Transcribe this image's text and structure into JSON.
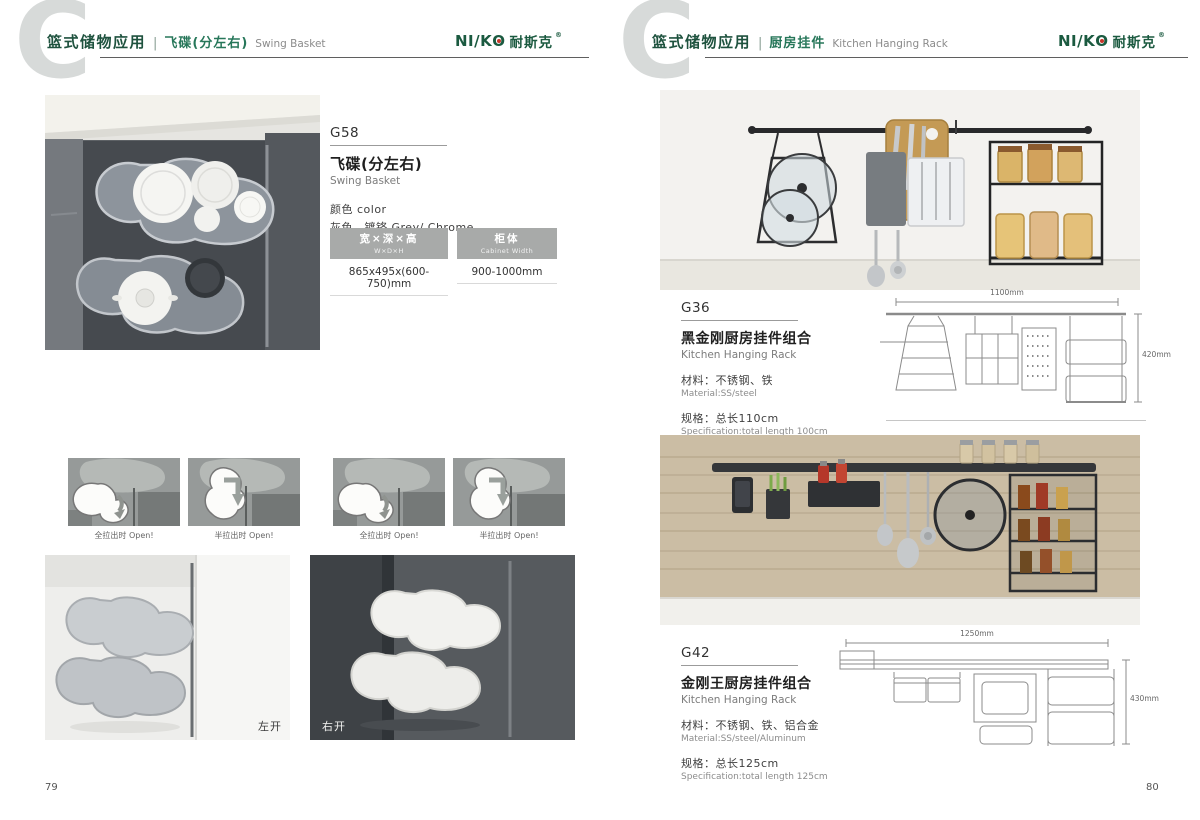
{
  "shared": {
    "watermark": "C",
    "header_sep": "|",
    "logo": {
      "latin": "NI/K",
      "o": "O",
      "cn": "耐斯克",
      "reg": "®"
    }
  },
  "colors": {
    "brand_green": "#1e523e",
    "logo_dot_red": "#c8352a",
    "watermark_gray": "#d7dad9",
    "table_header_gray": "#a8aaa9"
  },
  "left_page": {
    "header": {
      "category": "篮式储物应用",
      "subtitle_cn": "飞碟(分左右)",
      "subtitle_en": "Swing Basket"
    },
    "product": {
      "code": "G58",
      "name_cn": "飞碟(分左右)",
      "name_en": "Swing Basket",
      "color_label": "颜色 color",
      "color_value": "灰色、镀铬 Grey/ Chrome",
      "table": {
        "size_header_cn": "宽×深×高",
        "size_header_en": "W×D×H",
        "cabinet_header_cn": "柜体",
        "cabinet_header_en": "Cabinet Width",
        "size_value": "865x495x(600-750)mm",
        "cabinet_value": "900-1000mm"
      }
    },
    "diagram_captions": [
      "全拉出时 Open!",
      "半拉出时 Open!",
      "全拉出时 Open!",
      "半拉出时 Open!"
    ],
    "photo_labels": {
      "left": "左开",
      "right": "右开"
    },
    "page_number": "79"
  },
  "right_page": {
    "header": {
      "category": "篮式储物应用",
      "subtitle_cn": "厨房挂件",
      "subtitle_en": "Kitchen Hanging Rack"
    },
    "products": [
      {
        "code": "G36",
        "name_cn": "黑金刚厨房挂件组合",
        "name_en": "Kitchen Hanging Rack",
        "material_cn": "材料：不锈钢、铁",
        "material_en": "Material:SS/steel",
        "spec_cn": "规格：总长110cm",
        "spec_en": "Specification:total length 100cm",
        "dim_width": "1100mm",
        "dim_height": "420mm"
      },
      {
        "code": "G42",
        "name_cn": "金刚王厨房挂件组合",
        "name_en": "Kitchen Hanging Rack",
        "material_cn": "材料：不锈钢、铁、铝合金",
        "material_en": "Material:SS/steel/Aluminum",
        "spec_cn": "规格：总长125cm",
        "spec_en": "Specification:total length 125cm",
        "dim_width": "1250mm",
        "dim_height": "430mm"
      }
    ],
    "page_number": "80"
  }
}
